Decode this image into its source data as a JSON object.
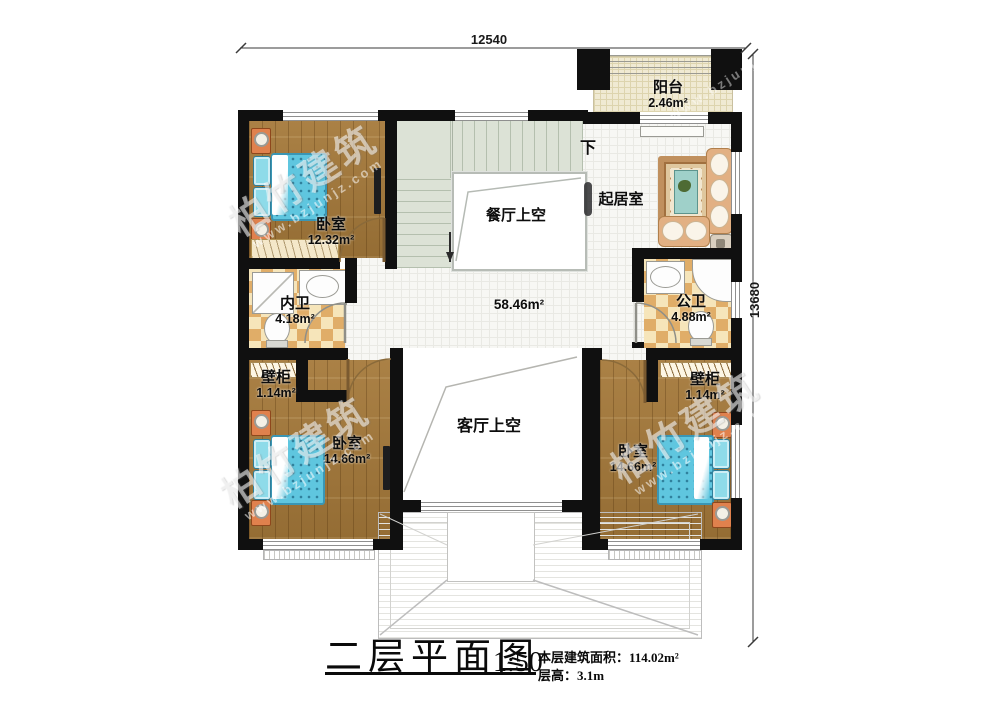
{
  "dimensions": {
    "top": "12540",
    "right": "13680"
  },
  "stair": {
    "down_label": "下"
  },
  "rooms": {
    "balcony": {
      "name": "阳台",
      "area": "2.46m²"
    },
    "bedroom_top_left": {
      "name": "卧室",
      "area": "12.32m²"
    },
    "dining_void": {
      "name": "餐厅上空"
    },
    "living_room": {
      "name": "起居室"
    },
    "hall": {
      "area": "58.46m²"
    },
    "inner_bath": {
      "name": "内卫",
      "area": "4.18m²"
    },
    "public_bath": {
      "name": "公卫",
      "area": "4.88m²"
    },
    "closet_left": {
      "name": "壁柜",
      "area": "1.14m²"
    },
    "closet_right": {
      "name": "壁柜",
      "area": "1.14m²"
    },
    "bedroom_bottom_left": {
      "name": "卧室",
      "area": "14.66m²"
    },
    "bedroom_bottom_right": {
      "name": "卧室",
      "area": "14.66m²"
    },
    "living_void": {
      "name": "客厅上空"
    }
  },
  "title_block": {
    "title": "二层平面图",
    "scale": "1:50",
    "area_label": "本层建筑面积：",
    "area_value": "114.02m²",
    "floor_height_label": "层高：",
    "floor_height_value": "3.1m"
  },
  "watermark": {
    "brand": "柏竹建筑",
    "url": "www.bzjunjz.com"
  },
  "colors": {
    "wall": "#101010",
    "wood_floor": "#a5793a",
    "tile_dark": "#e0ad68",
    "tile_light": "#f6e5ba",
    "stair": "#dce2d6",
    "bed": "#5fc6df",
    "balcony_floor": "#f0ead3",
    "sofa": "#e2b083"
  }
}
